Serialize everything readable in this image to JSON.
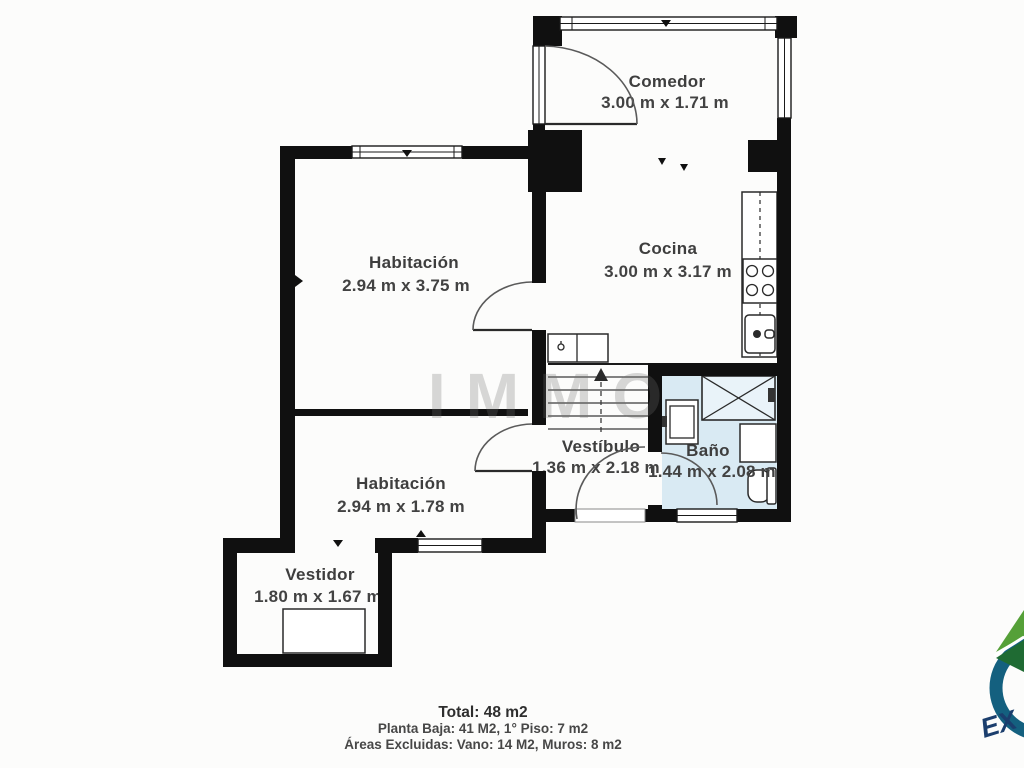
{
  "floor_plan": {
    "rooms": [
      {
        "id": "comedor",
        "name": "Comedor",
        "dims": "3.00 m x 1.71 m"
      },
      {
        "id": "cocina",
        "name": "Cocina",
        "dims": "3.00 m x 3.17 m"
      },
      {
        "id": "habitacion-1",
        "name": "Habitación",
        "dims": "2.94 m x 3.75 m"
      },
      {
        "id": "habitacion-2",
        "name": "Habitación",
        "dims": "2.94 m x 1.78 m"
      },
      {
        "id": "vestibulo",
        "name": "Vestíbulo",
        "dims": "1.36 m x 2.18 m"
      },
      {
        "id": "bano",
        "name": "Baño",
        "dims": "1.44 m x 2.08 m"
      },
      {
        "id": "vestidor",
        "name": "Vestidor",
        "dims": "1.80 m x 1.67 m"
      }
    ],
    "fixtures": [
      "stairs-up",
      "kitchen-counter",
      "stove",
      "kitchen-sink",
      "utility-sink",
      "shower",
      "bathroom-sink",
      "bathroom-cabinet",
      "toilet",
      "wardrobe"
    ],
    "watermark": "IMMO",
    "summary": {
      "total": "Total: 48 m2",
      "floors": "Planta Baja: 41 M2, 1° Piso: 7 m2",
      "excluded": "Áreas Excluidas: Vano: 14 M2, Muros: 8 m2"
    },
    "logo": {
      "text": "EX"
    },
    "colors": {
      "wall": "#101010",
      "bath_floor": "#d9eaf3",
      "label": "#3e3e3e",
      "logo_green_light": "#55a038",
      "logo_green_dark": "#1f6b33",
      "logo_teal": "#14607f",
      "logo_navy": "#1b3e6d"
    }
  }
}
